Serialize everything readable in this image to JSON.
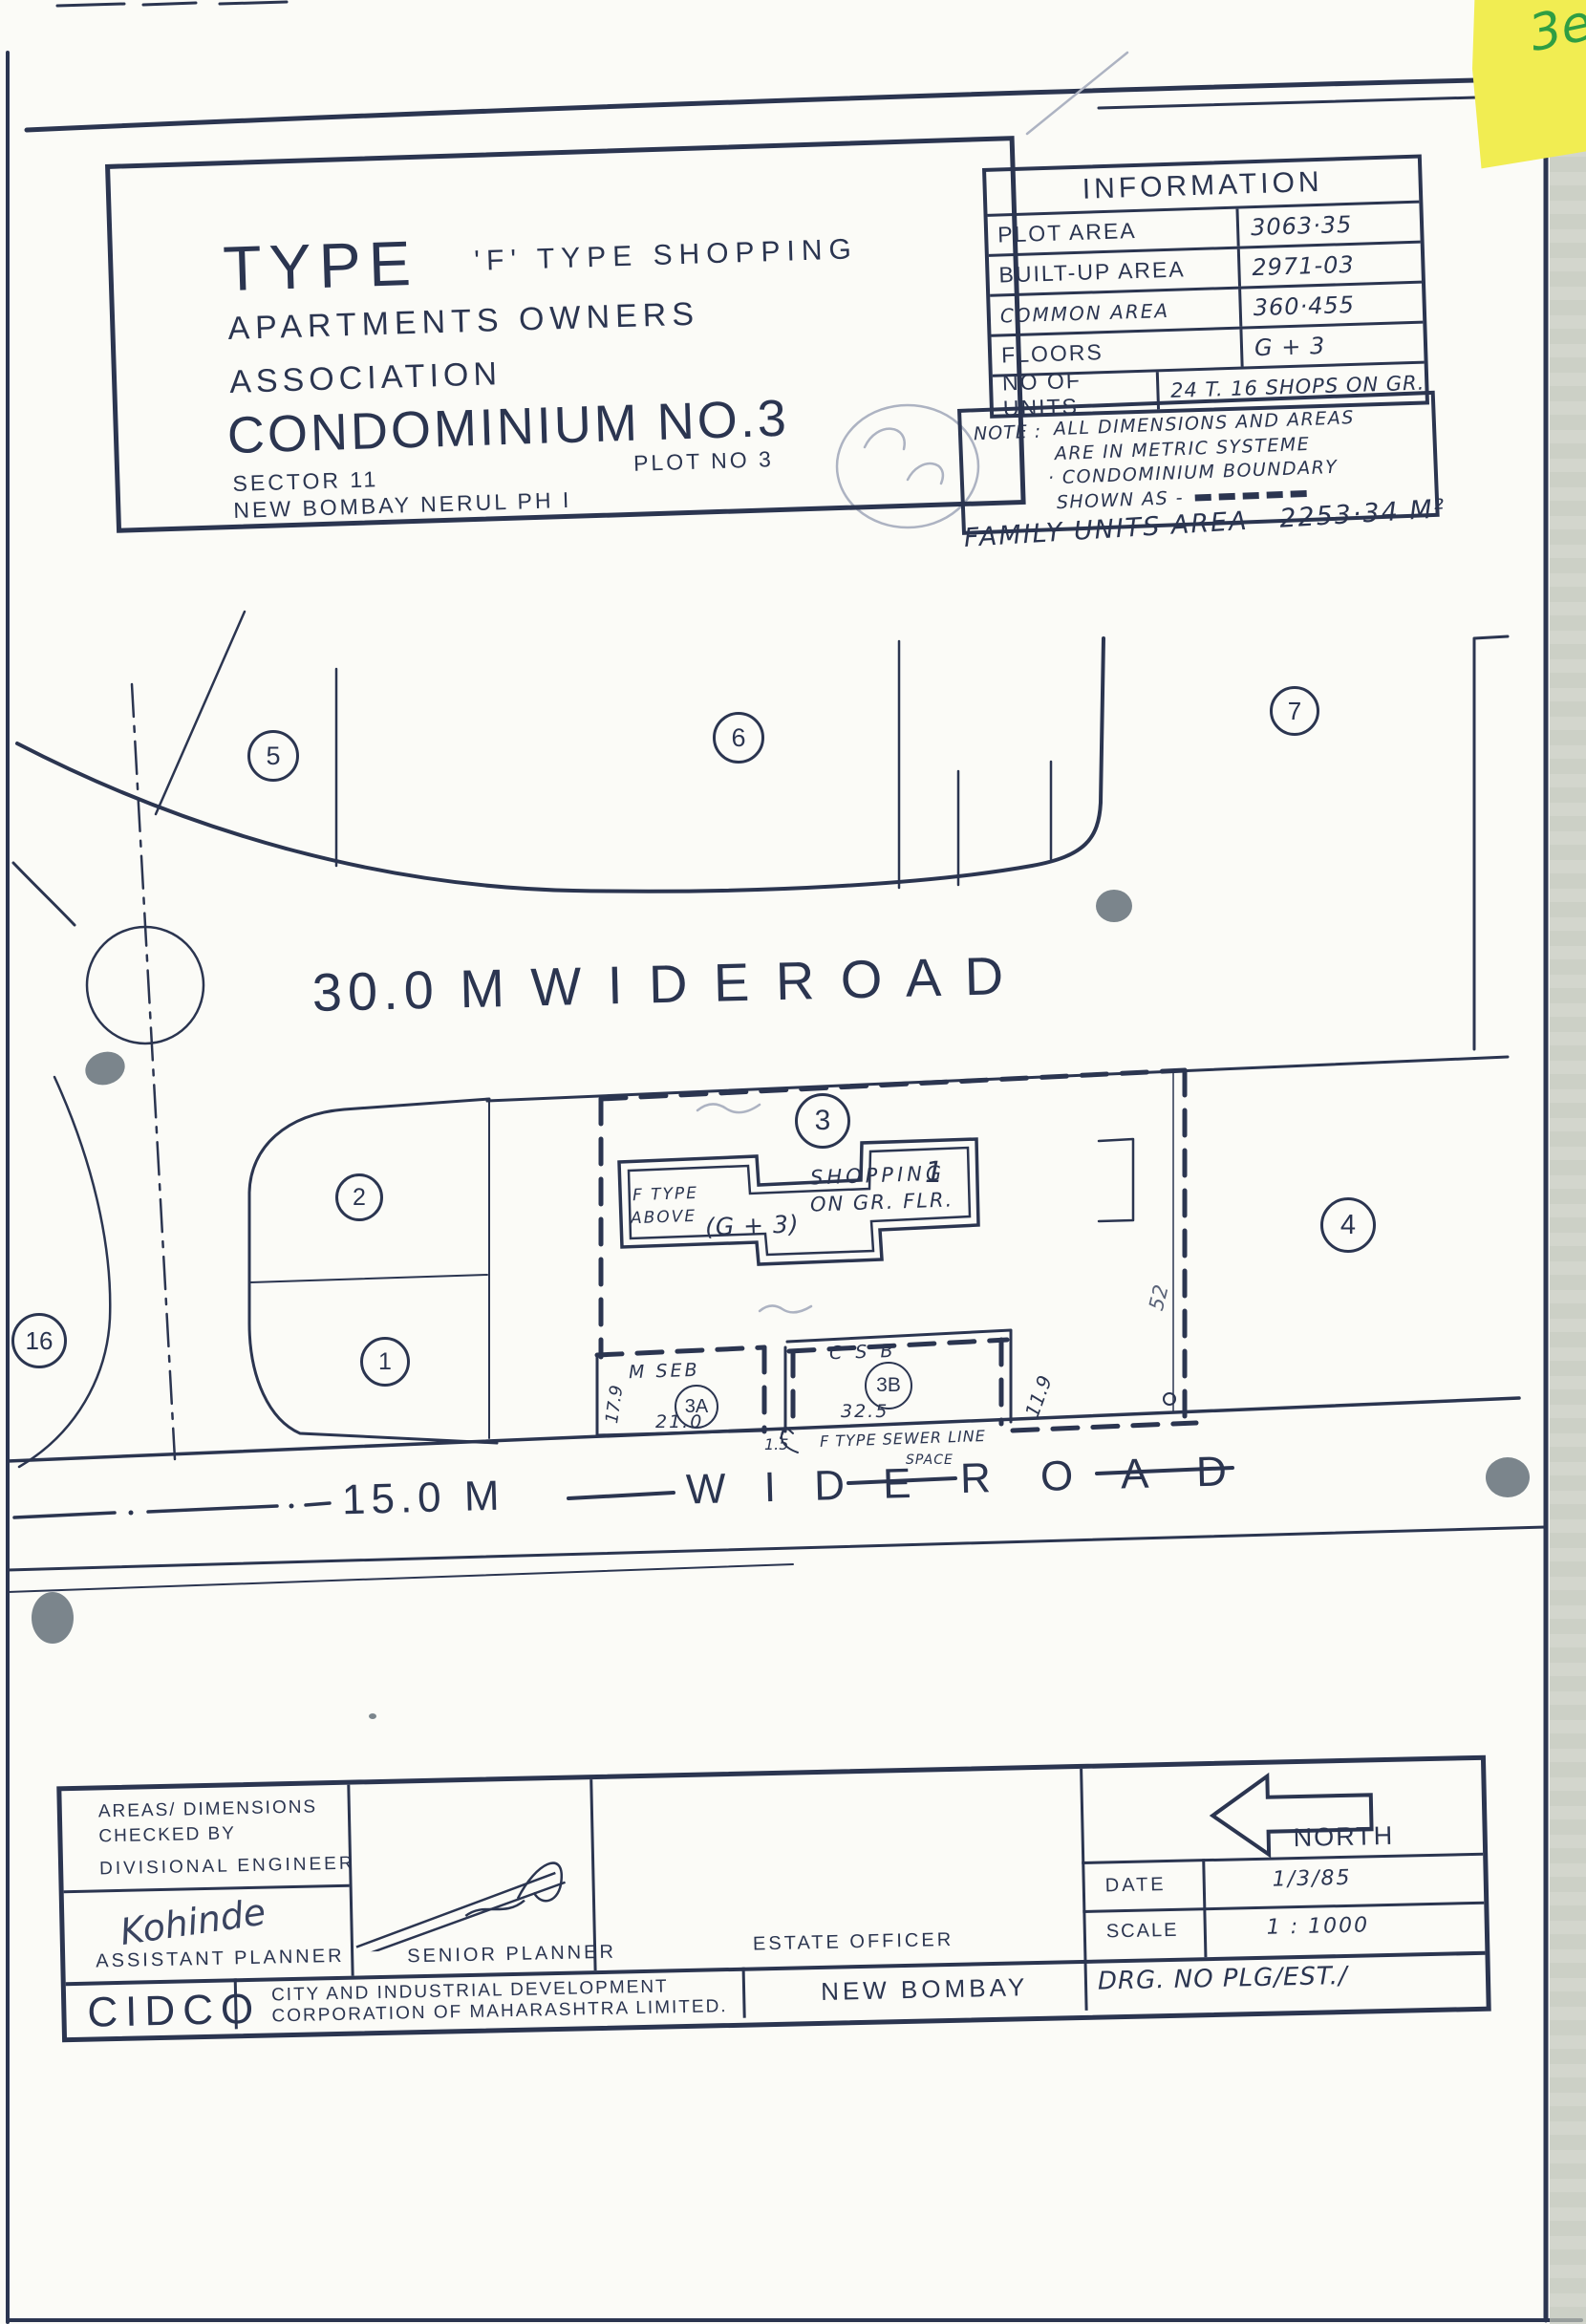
{
  "colors": {
    "ink": "#2b3550",
    "paper": "#fbfbf7",
    "sticky_yellow": "#f1ed52",
    "stamp_green": "#2f9e43",
    "pencil_gray": "#9aa2b2",
    "blob_gray": "#7b858c"
  },
  "sticky_note": {
    "handwriting": "3e"
  },
  "header_box": {
    "type_word": "TYPE",
    "type_rest": "'F' TYPE SHOPPING",
    "line2": "APARTMENTS OWNERS",
    "line3": "ASSOCIATION",
    "line4": "CONDOMINIUM NO.3",
    "sector": "SECTOR 11",
    "plot_no": "PLOT NO 3",
    "location": "NEW BOMBAY NERUL PH I"
  },
  "info_table": {
    "title": "INFORMATION",
    "rows": [
      {
        "label": "PLOT AREA",
        "value": "3063·35"
      },
      {
        "label": "BUILT-UP AREA",
        "value": "2971-03"
      },
      {
        "label": "COMMON AREA",
        "value": "360·455"
      },
      {
        "label": "FLOORS",
        "value": "G + 3"
      },
      {
        "label": "NO OF UNITS",
        "value": "24 T. 16 SHOPS ON GR."
      }
    ]
  },
  "note_box": {
    "label": "NOTE :",
    "line1": "ALL DIMENSIONS AND AREAS",
    "line2": "ARE IN METRIC SYSTEME",
    "line3": "· CONDOMINIUM BOUNDARY",
    "line4": "SHOWN AS -"
  },
  "family_units_area": "FAMILY UNITS AREA - 2253·34 M²",
  "site_plan": {
    "road_top": "30.0 M    W I D E      R O A D",
    "road_bottom": {
      "part1": "15.0 M",
      "part2": "W I D E",
      "part3": "R O A D"
    },
    "plot_labels": {
      "p1": "1",
      "p2": "2",
      "p3": "3",
      "p4": "4",
      "p5": "5",
      "p6": "6",
      "p7": "7",
      "p16": "16",
      "p3a": "3A",
      "p3b": "3B"
    },
    "building": {
      "line1": "F TYPE",
      "line2": "ABOVE",
      "g3": "(G + 3)",
      "shop1": "SHOPPING",
      "shop2": "ON GR. FLR.",
      "unit": "1"
    },
    "areas": {
      "mseb": "M SEB",
      "csb": "C S B"
    },
    "dims": {
      "mseb_w": "21.0",
      "mseb_h": "17.9",
      "gap": "1.5",
      "csb_w": "32.5",
      "csb_h": "11.9",
      "right": "52"
    },
    "sewer_line": "F TYPE SEWER LINE",
    "sewer_space": "SPACE"
  },
  "title_block": {
    "checked_by1": "AREAS/ DIMENSIONS",
    "checked_by2": "CHECKED BY",
    "divisional": "DIVISIONAL ENGINEER",
    "signature1": "Kohinde",
    "assistant": "ASSISTANT PLANNER",
    "senior": "SENIOR PLANNER",
    "estate": "ESTATE OFFICER",
    "north": "NORTH",
    "date_label": "DATE",
    "date_value": "1/3/85",
    "scale_label": "SCALE",
    "scale_value": "1 : 1000",
    "org_abbrev": "CIDCO",
    "org_line1": "CITY AND INDUSTRIAL DEVELOPMENT",
    "org_line2": "CORPORATION OF MAHARASHTRA LIMITED.",
    "office": "NEW BOMBAY",
    "drg_no": "DRG. NO PLG/EST./"
  }
}
